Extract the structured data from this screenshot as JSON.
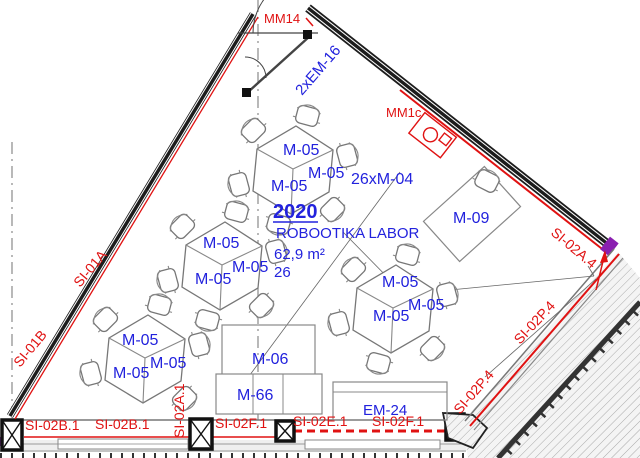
{
  "drawing_type": "architectural floor plan",
  "room": {
    "number": "2020",
    "name": "ROBOOTIKA LABOR",
    "area": "62,9 m²",
    "capacity": "26"
  },
  "equipment": {
    "em16": "2xEM-16",
    "m04": "26xM-04",
    "m05": "M-05",
    "m05_count_shown": 12,
    "m09": "M-09",
    "m06": "M-06",
    "m66": "M-66",
    "em24": "EM-24"
  },
  "markers": {
    "mm14": "MM14",
    "mm1c": "MM1c"
  },
  "wall_codes": {
    "si01a": "SI-01A",
    "si01b": "SI-01B",
    "si02b1_left": "SI-02B.1",
    "si02b1_right": "SI-02B.1",
    "si02a1": "SI-02A.1",
    "si02f1_left": "SI-02F.1",
    "si02e1": "SI-02E.1",
    "si02f1_right": "SI-02F.1",
    "si02a4": "SI-02A.4",
    "si02p4_upper": "SI-02P.4",
    "si02p4_lower": "SI-02P.4"
  },
  "colors": {
    "equipment_blue": "#2222dd",
    "wall_code_red": "#e01212",
    "wall_dark": "#1c1c1c",
    "line_gray": "#777777",
    "junction_purple": "#8a1fb0"
  }
}
